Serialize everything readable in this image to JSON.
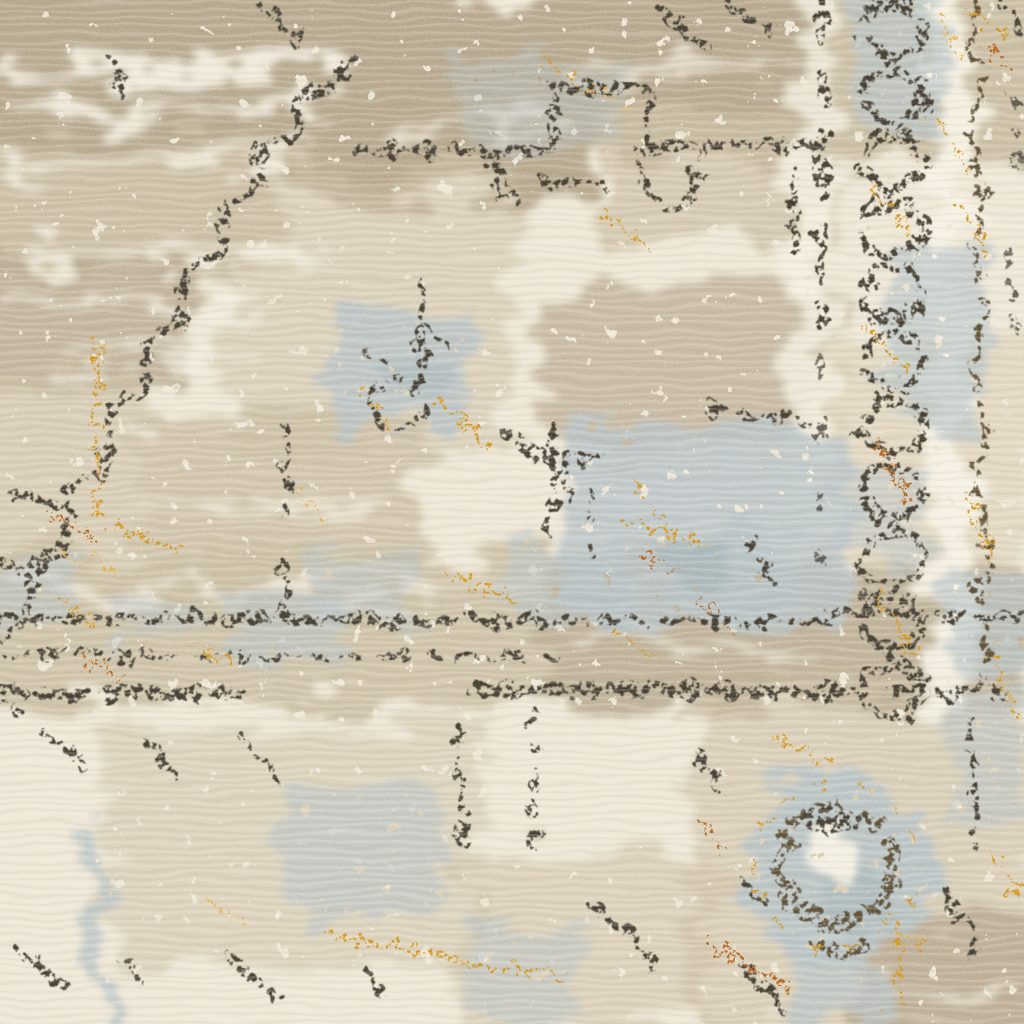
{
  "scene": {
    "type": "photograph",
    "subject": "Close-up of a distressed vintage-style oriental area rug",
    "description": "Macro photograph of cut-pile area rug showing a faded oriental medallion pattern: ivory and beige ground, stepped charcoal outline descending diagonally on the left, a speckled horizontal band across the middle, a guard border with a dark chain motif and vine running down the right side, a circular blue-grey and charcoal rosette in the lower right, pale blue-grey florets and scattered gold and rust flecks throughout.",
    "texture": "mottled eroded print on soft carpet pile, fine grain, horizontal weave ribs"
  },
  "palette": {
    "cream_base": "#ede5d3",
    "cream_light": "#f6f0e1",
    "cream_shadow": "#dcd1b9",
    "taupe": "#b3a489",
    "taupe_light": "#c8bba0",
    "taupe_dark": "#9b8d74",
    "charcoal": "#3a3529",
    "brown": "#55462f",
    "blue_gray": "#b4c0c3",
    "blue_gray_deep": "#97a9ae",
    "gold": "#d1921f",
    "gold_light": "#e4ae45",
    "rust": "#b2601c"
  },
  "motifs": [
    "top-left beige field with cream streaks",
    "stepped diagonal medallion outline",
    "medallion top edge line with raised step",
    "right guard border: chain links, vine, gold flecks",
    "speckled horizontal band across middle",
    "large blue-grey patch right of center",
    "circular rosette lower right with charcoal ring and cream eye",
    "blue-grey florets and wisps",
    "gold and rust fleck trails"
  ]
}
